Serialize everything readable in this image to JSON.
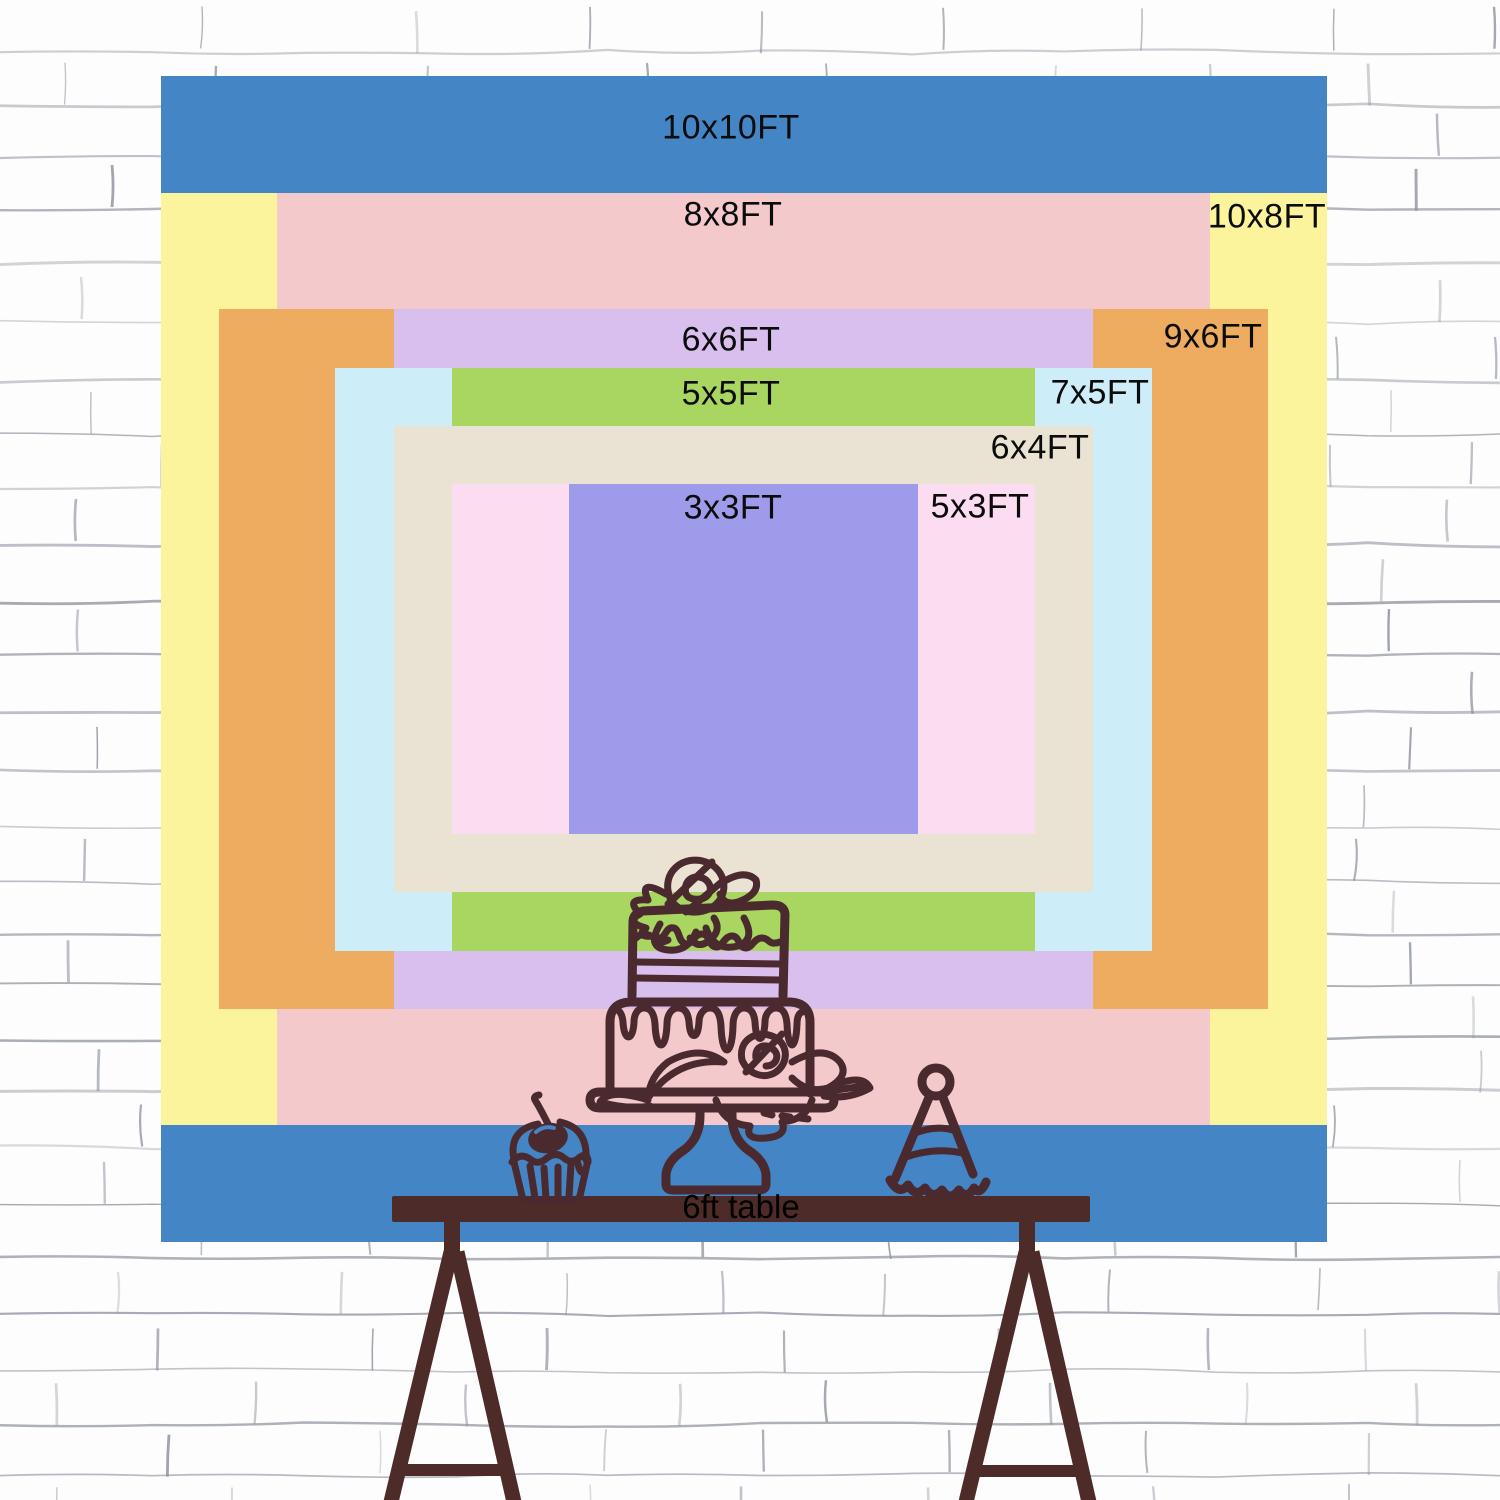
{
  "backdrop": {
    "px_per_ft": 116.6,
    "x": 160,
    "y": 76,
    "width": 1167,
    "height": 1166,
    "layers": [
      {
        "label": "10x10FT",
        "w_ft": 10,
        "h_ft": 10,
        "color": "#4385c5",
        "label_x": 731,
        "label_y": 128
      },
      {
        "label": "10x8FT",
        "w_ft": 10,
        "h_ft": 8,
        "color": "#fbf49d",
        "label_x": 1267,
        "label_y": 217
      },
      {
        "label": "8x8FT",
        "w_ft": 8,
        "h_ft": 8,
        "color": "#f4c9cb",
        "label_x": 733,
        "label_y": 215
      },
      {
        "label": "9x6FT",
        "w_ft": 9,
        "h_ft": 6,
        "color": "#eeac60",
        "label_x": 1213,
        "label_y": 337
      },
      {
        "label": "6x6FT",
        "w_ft": 6,
        "h_ft": 6,
        "color": "#d9bfee",
        "label_x": 731,
        "label_y": 340
      },
      {
        "label": "7x5FT",
        "w_ft": 7,
        "h_ft": 5,
        "color": "#cdedf8",
        "label_x": 1100,
        "label_y": 393
      },
      {
        "label": "5x5FT",
        "w_ft": 5,
        "h_ft": 5,
        "color": "#a9d561",
        "label_x": 731,
        "label_y": 394
      },
      {
        "label": "6x4FT",
        "w_ft": 6,
        "h_ft": 4,
        "color": "#eae3d3",
        "label_x": 1040,
        "label_y": 448
      },
      {
        "label": "5x3FT",
        "w_ft": 5,
        "h_ft": 3,
        "color": "#fbdcf0",
        "label_x": 980,
        "label_y": 507
      },
      {
        "label": "3x3FT",
        "w_ft": 3,
        "h_ft": 3,
        "color": "#9e9bea",
        "label_x": 733,
        "label_y": 508
      }
    ]
  },
  "table": {
    "label": "6ft table",
    "color": "#4c2b29"
  },
  "artwork": {
    "ink": "#4a2a2e",
    "cherry_highlight_blue": "#4385c5"
  },
  "wall": {
    "background": "#ffffff",
    "mortar_line": "#8f949e"
  }
}
